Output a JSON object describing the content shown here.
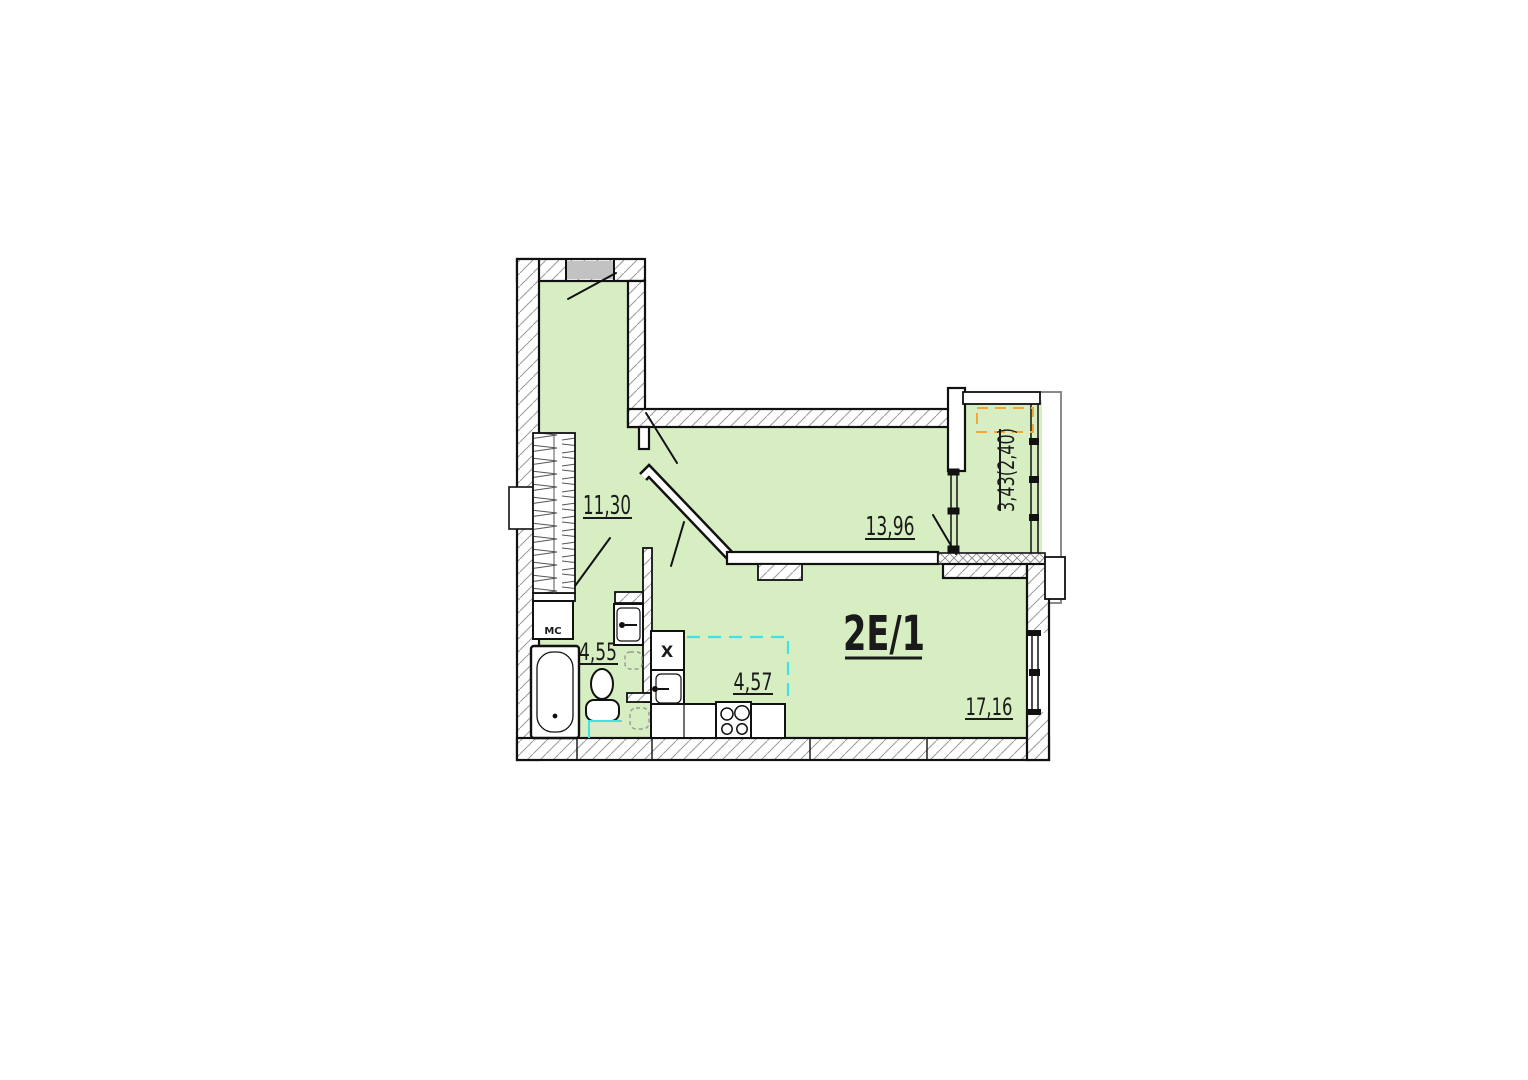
{
  "plan": {
    "unit": {
      "label": "2Е/1",
      "total_area": "53,94"
    },
    "rooms": {
      "hallway": {
        "area": "11,30"
      },
      "room": {
        "area": "13,96"
      },
      "balcony": {
        "area": "3,43(2,40)"
      },
      "bathroom": {
        "area": "4,55"
      },
      "kitchen": {
        "area": "4,57"
      },
      "living": {
        "area": "17,16"
      }
    },
    "fixtures": {
      "washing_machine": "МС",
      "fridge": "Х"
    },
    "colors": {
      "floor_green": "#d7eec3",
      "kitchen_zone_dash": "#3fe3e3",
      "balcony_zone_dash": "#f0a838",
      "entry_door_gray": "#c2c2c2",
      "wall_outline": "#111111"
    }
  }
}
